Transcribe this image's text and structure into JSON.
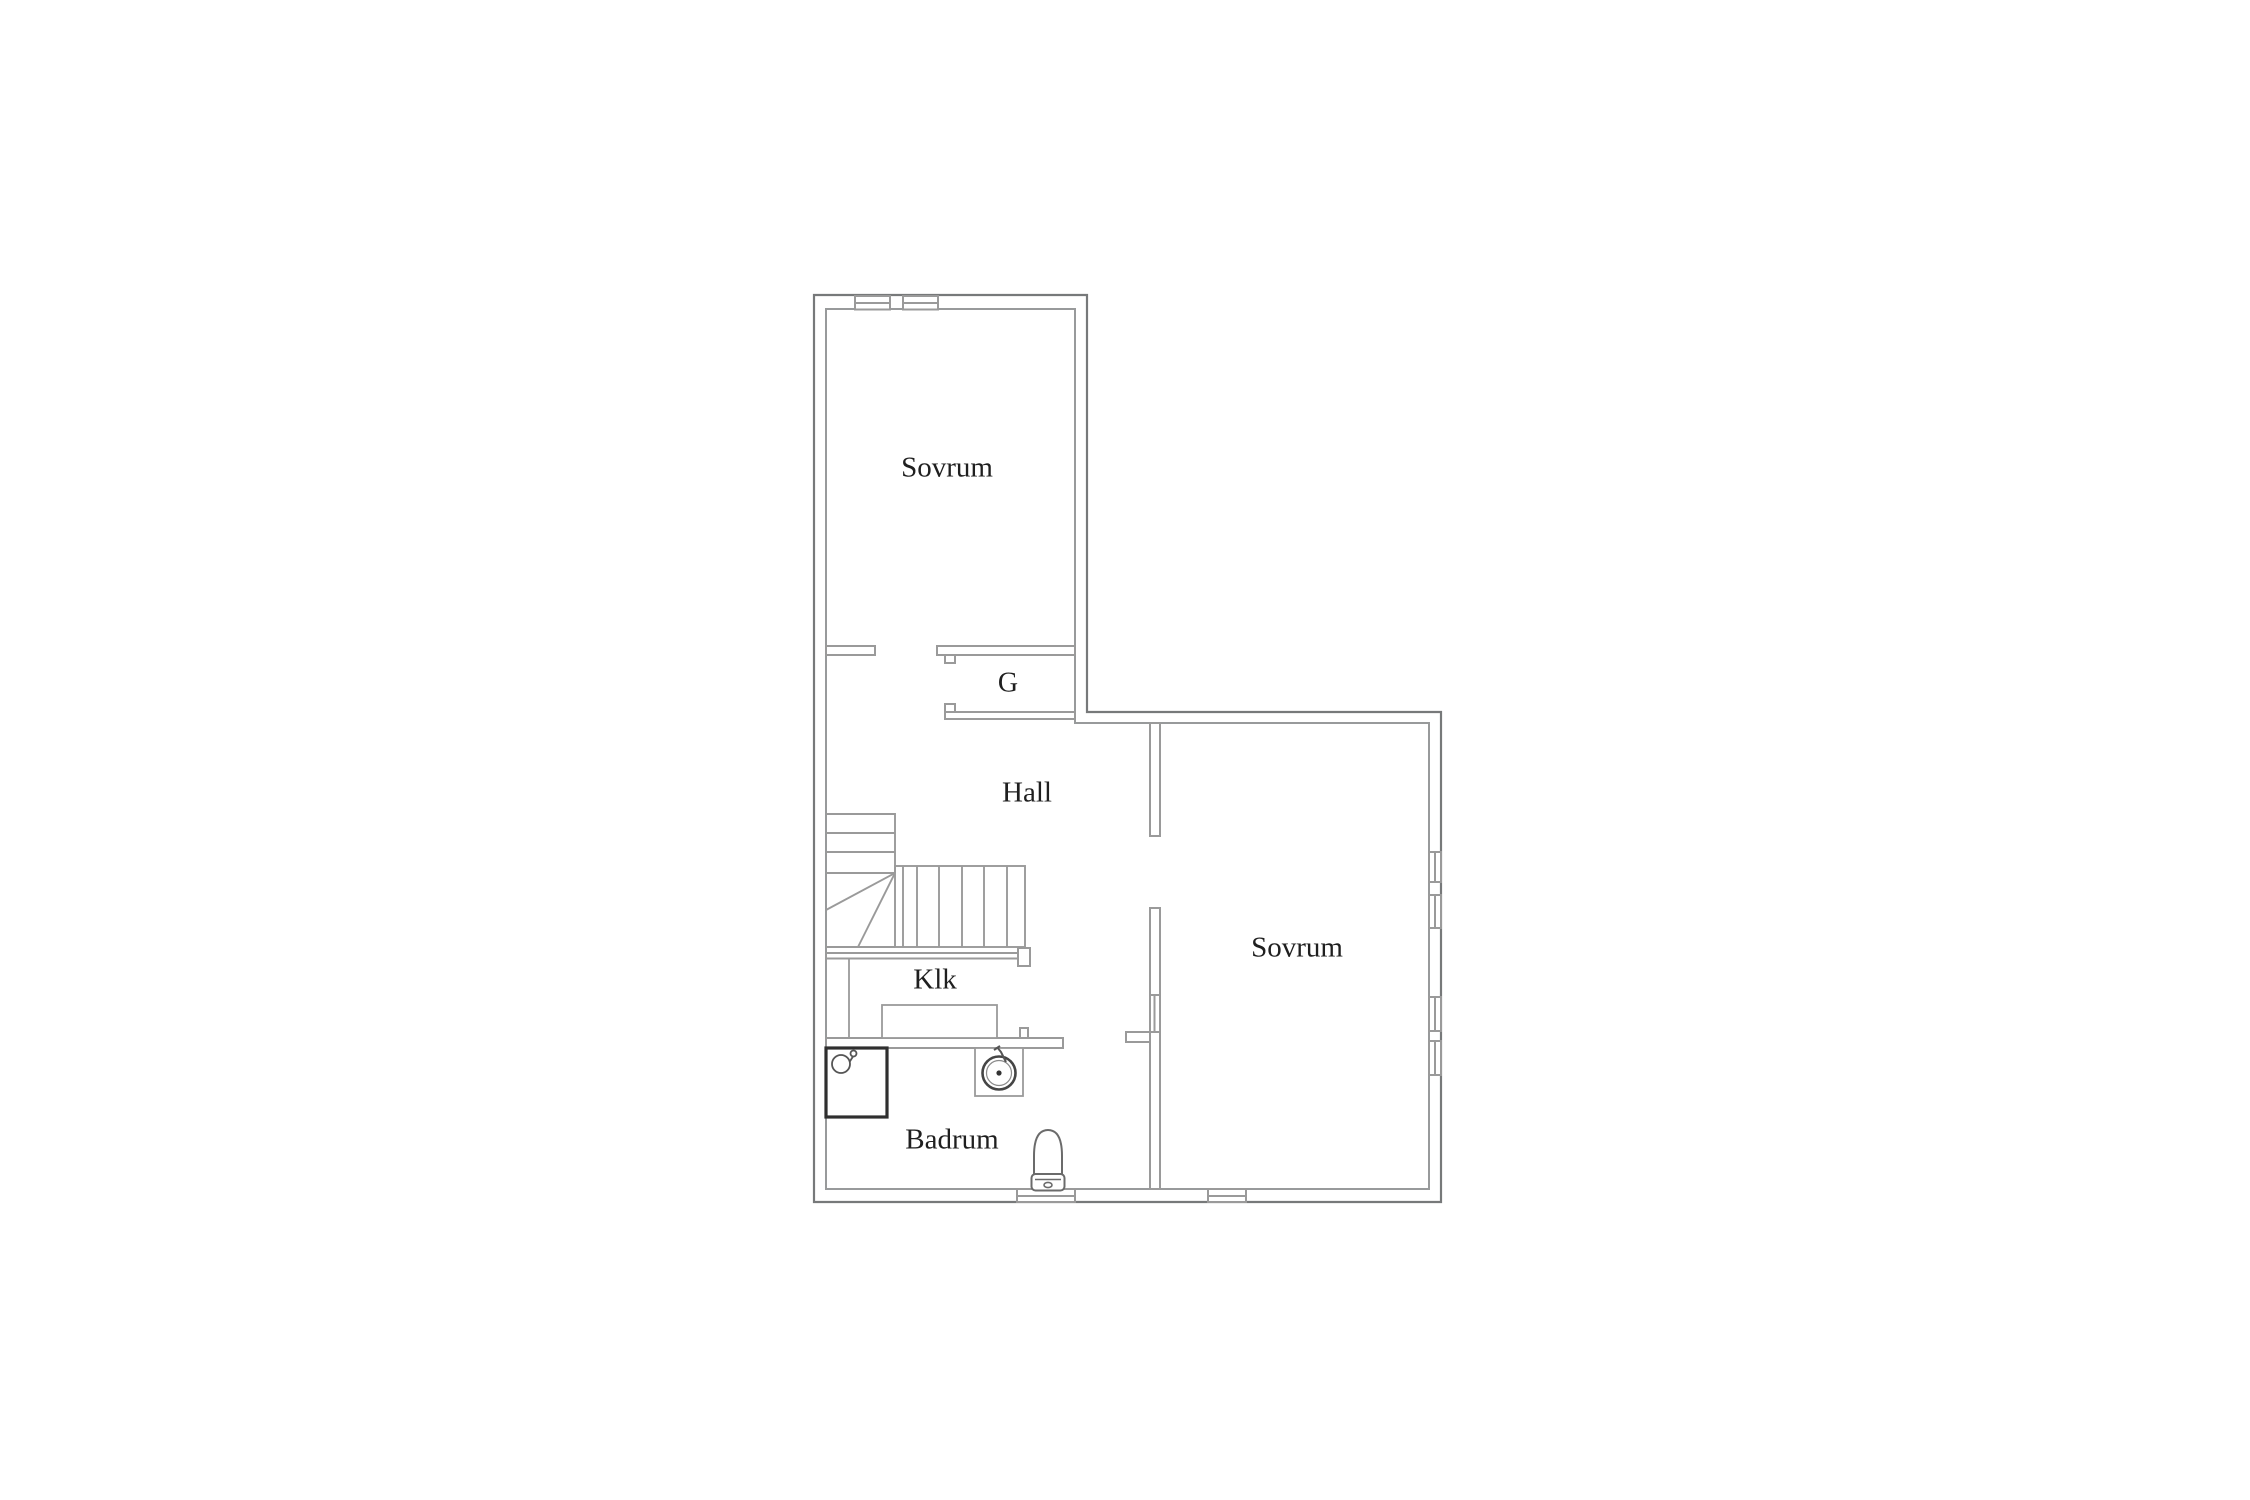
{
  "floorplan": {
    "type": "residential-floor-plan",
    "language": "Swedish",
    "rooms": [
      {
        "label": "Sovrum",
        "meaning": "bedroom",
        "position": "top-left"
      },
      {
        "label": "G",
        "meaning": "wardrobe-closet",
        "position": "center-upper"
      },
      {
        "label": "Hall",
        "meaning": "hallway",
        "position": "center"
      },
      {
        "label": "Sovrum",
        "meaning": "bedroom",
        "position": "right"
      },
      {
        "label": "Klk",
        "meaning": "walk-in-closet",
        "position": "left-middle"
      },
      {
        "label": "Badrum",
        "meaning": "bathroom",
        "position": "bottom-left"
      }
    ],
    "fixtures": [
      {
        "name": "staircase",
        "style": "winder-stair-with-diagonal-treads"
      },
      {
        "name": "shower",
        "style": "dark-bordered-square-with-drain-circle"
      },
      {
        "name": "sink",
        "style": "round-basin-in-square-counter"
      },
      {
        "name": "toilet",
        "style": "oval-bowl-with-tank"
      },
      {
        "name": "wardrobe",
        "style": "plain-rectangle"
      }
    ],
    "windows": [
      "top-wall-pair",
      "right-wall-upper-pair",
      "right-wall-lower-pair",
      "bottom-wall-bathroom-sill",
      "bottom-wall-bedroom-sill",
      "hall-bedroom-partition-glazing"
    ],
    "colors": {
      "background": "#ffffff",
      "exterior_wall": "#77797a",
      "interior_wall": "#9a9a9a",
      "stair_line": "#9a9a9a",
      "fixture_dark": "#2f2f2f",
      "fixture_mid": "#555555",
      "text": "#1f1f1f"
    }
  }
}
